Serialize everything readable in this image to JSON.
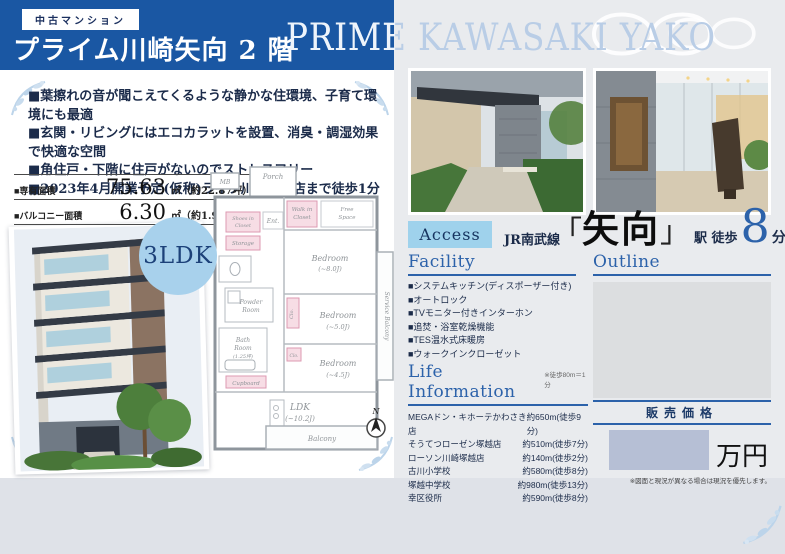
{
  "header": {
    "badge": "中古マンション",
    "title": "プライム川崎矢向 2 階",
    "title_en": "PRIME KAWASAKI YAKO"
  },
  "features": [
    "■葉擦れの音が聞こえてくるような静かな住環境、子育て環境にも最適",
    "■玄関・リビングにはエコカラットを設置、消臭・調湿効果で快適な空間",
    "■角住戸・下階に住戸がないのでストレスフリー",
    "■2023年4月開業予定(仮称)ライフ川崎塚越店まで徒歩1分"
  ],
  "areas": [
    {
      "label": "■専有面積",
      "value": "75.63",
      "unit": "㎡（約22.87坪）"
    },
    {
      "label": "■バルコニー面積",
      "value": "6.30",
      "unit": "㎡（約1.90坪）"
    }
  ],
  "layout_badge": "3LDK",
  "floorplan": {
    "porch": "Porch",
    "mb": "MB",
    "wic_1": "Walk in",
    "wic_2": "Closet",
    "free_1": "Free",
    "free_2": "Space",
    "bed8_1": "Bedroom",
    "bed8_2": "(~8.0J)",
    "shoes_1": "Shoes in",
    "shoes_2": "Closet",
    "ent": "Ent.",
    "storage": "Storage",
    "powder_1": "Powder",
    "powder_2": "Room",
    "bath_1": "Bath",
    "bath_2": "Room",
    "bath_3": "(1.25坪)",
    "clo_1": "Clo.",
    "clo_2": "Clo.",
    "bed5_1": "Bedroom",
    "bed5_2": "(~5.0J)",
    "bed45_1": "Bedroom",
    "bed45_2": "(~4.5J)",
    "service": "Service Balcony",
    "cupboard": "Cupboard",
    "ldk_1": "LDK",
    "ldk_2": "(~10.2J)",
    "balcony": "Balcony",
    "north": "N"
  },
  "access": {
    "badge": "Access",
    "rail_line": "JR南武線",
    "bracket_open": "「",
    "station": "矢向",
    "bracket_close": "」",
    "walk_label": "駅 徒歩",
    "walk_minutes": "8",
    "walk_unit": "分"
  },
  "facility": {
    "heading": "Facility",
    "items": [
      "■システムキッチン(ディスポーザー付き)",
      "■オートロック",
      "■TVモニター付きインターホン",
      "■追焚・浴室乾燥機能",
      "■TES温水式床暖房",
      "■ウォークインクローゼット"
    ]
  },
  "life_information": {
    "heading": "Life Information",
    "note": "※徒歩80m＝1分",
    "rows": [
      {
        "name": "MEGAドン・キホーテかわさき店",
        "distance": "約650m(徒歩9分)"
      },
      {
        "name": "そうてつローゼン塚越店",
        "distance": "約510m(徒歩7分)"
      },
      {
        "name": "ローソン川崎塚越店",
        "distance": "約140m(徒歩2分)"
      },
      {
        "name": "古川小学校",
        "distance": "約580m(徒歩8分)"
      },
      {
        "name": "塚越中学校",
        "distance": "約980m(徒歩13分)"
      },
      {
        "name": "幸区役所",
        "distance": "約590m(徒歩8分)"
      }
    ]
  },
  "outline": {
    "heading": "Outline"
  },
  "price": {
    "label": "販売価格",
    "unit": "万円",
    "note": "※図面と現況が異なる場合は現況を優先します。"
  },
  "colors": {
    "header_blue": "#1a57a3",
    "accent_blue": "#2c62aa",
    "light_blue_badge": "#9fd2ec",
    "ldk_circle": "#a8d1ec",
    "title_en_blue": "#b9cde6",
    "price_redact": "#b6bfd5"
  }
}
